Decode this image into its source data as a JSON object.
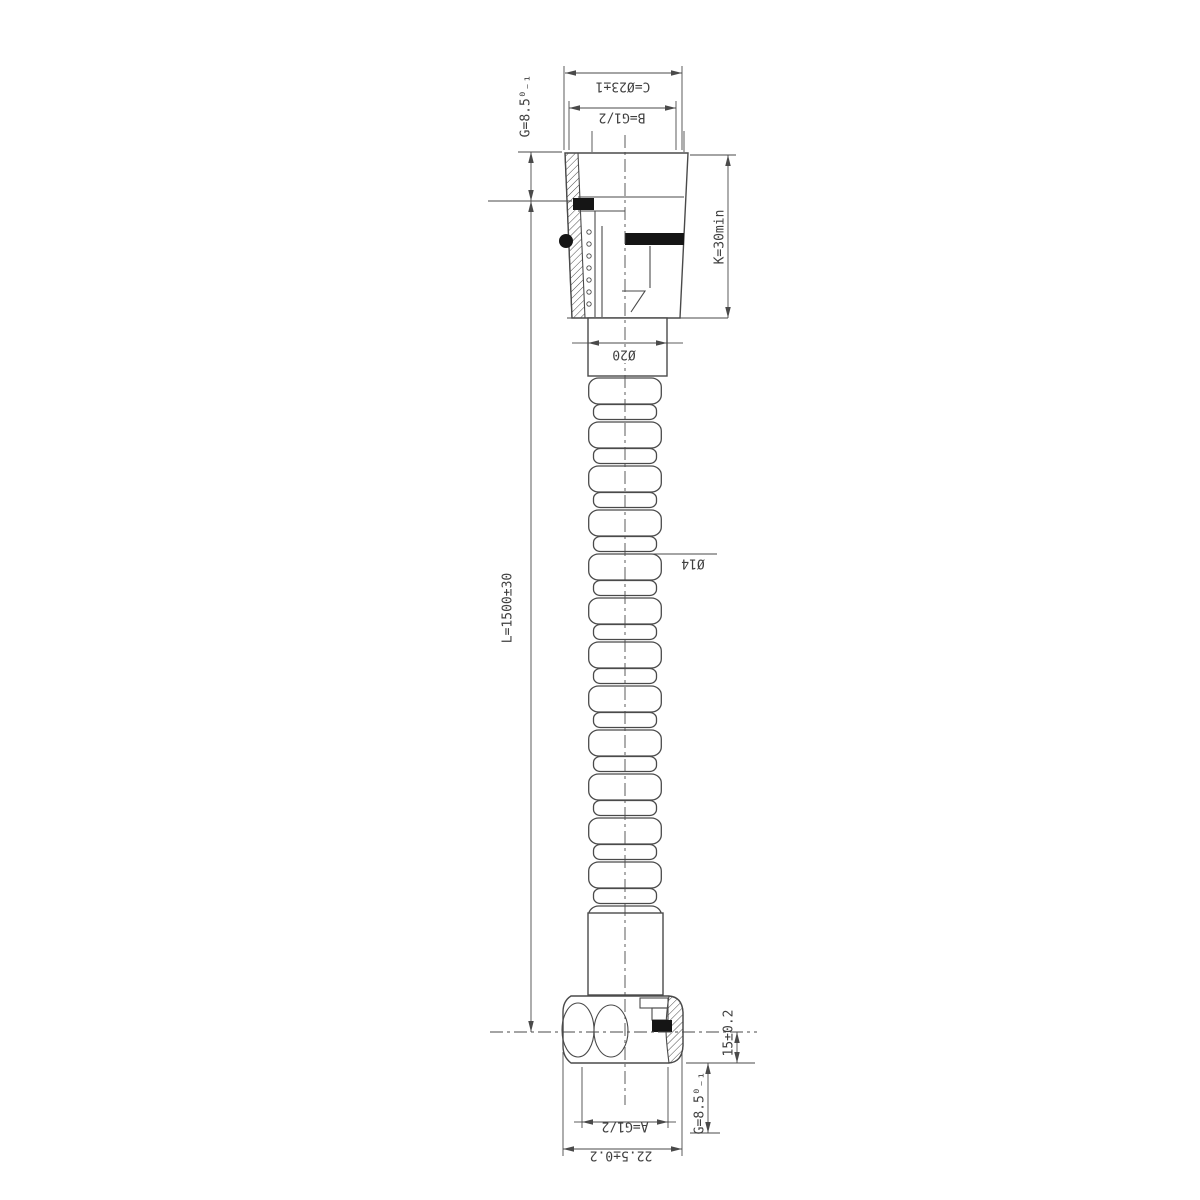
{
  "drawing": {
    "type": "technical-drawing",
    "subject": "flexible shower hose cross-section",
    "background": "#ffffff",
    "line_color": "#4a4a4a",
    "seal_color": "#151515",
    "labels": {
      "g_top": "G=8.5⁰₋₁",
      "c_dia": "C=Ø23±1",
      "b_thread": "B=G1/2",
      "k_height": "K=30min",
      "neck_dia": "Ø20",
      "hose_dia": "Ø14",
      "length": "L=1500±30",
      "offset": "15±0.2",
      "g_bottom": "G=8.5⁰₋₁",
      "a_thread": "A=G1/2",
      "nut_width": "22.5±0.2"
    }
  }
}
